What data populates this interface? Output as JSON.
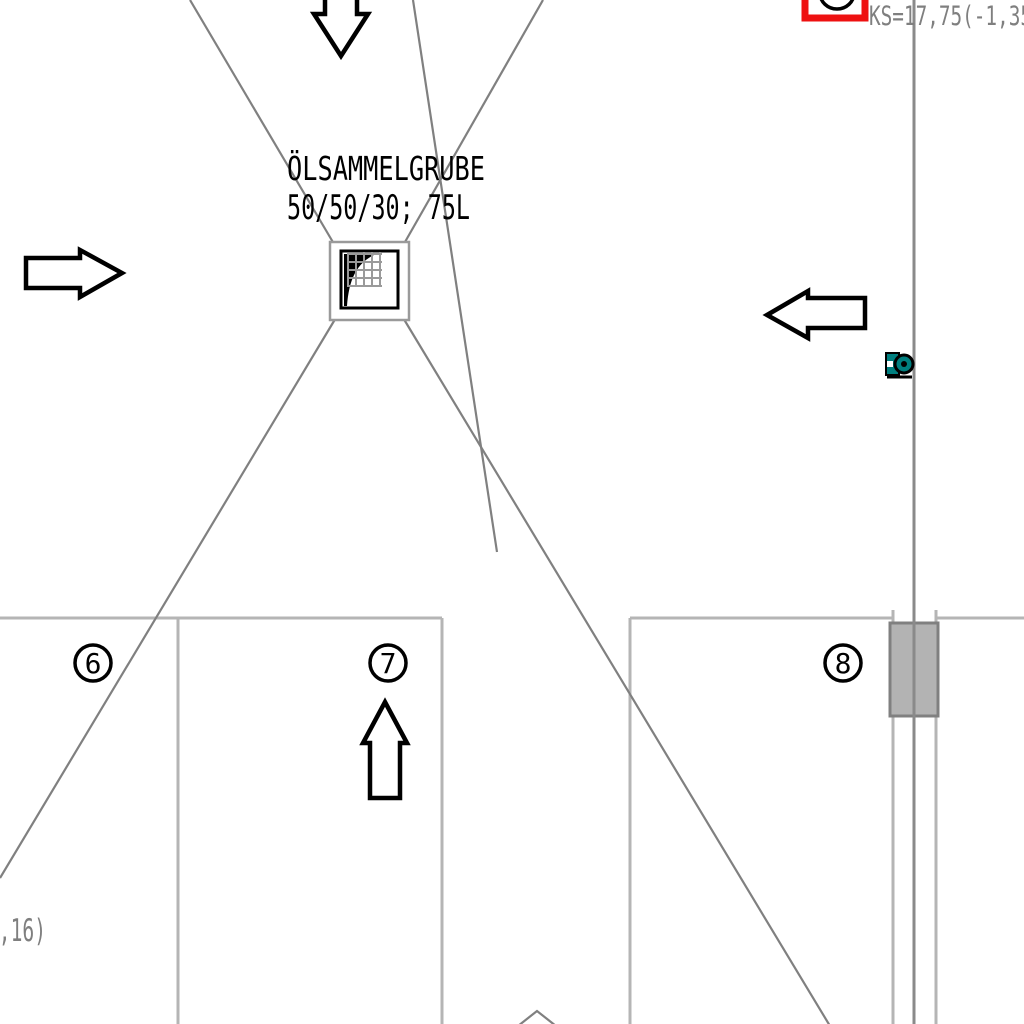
{
  "plan": {
    "annotations": {
      "oil_pit_label_line1": "ÖLSAMMELGRUBE",
      "oil_pit_label_line2": "50/50/30; 75L",
      "level_note": "KS=17,75(-1,35",
      "partial_level_note": "1,16)"
    },
    "grid_bubbles": [
      {
        "label": "6"
      },
      {
        "label": "7"
      },
      {
        "label": "8"
      }
    ],
    "colors": {
      "slope_line": "#808080",
      "structure_line": "#b5b5b5",
      "marker_red": "#ee1111",
      "symbol_teal": "#007f7f",
      "column_fill": "#b3b3b3",
      "ink": "#000000",
      "note_gray": "#7f7f7f"
    }
  }
}
